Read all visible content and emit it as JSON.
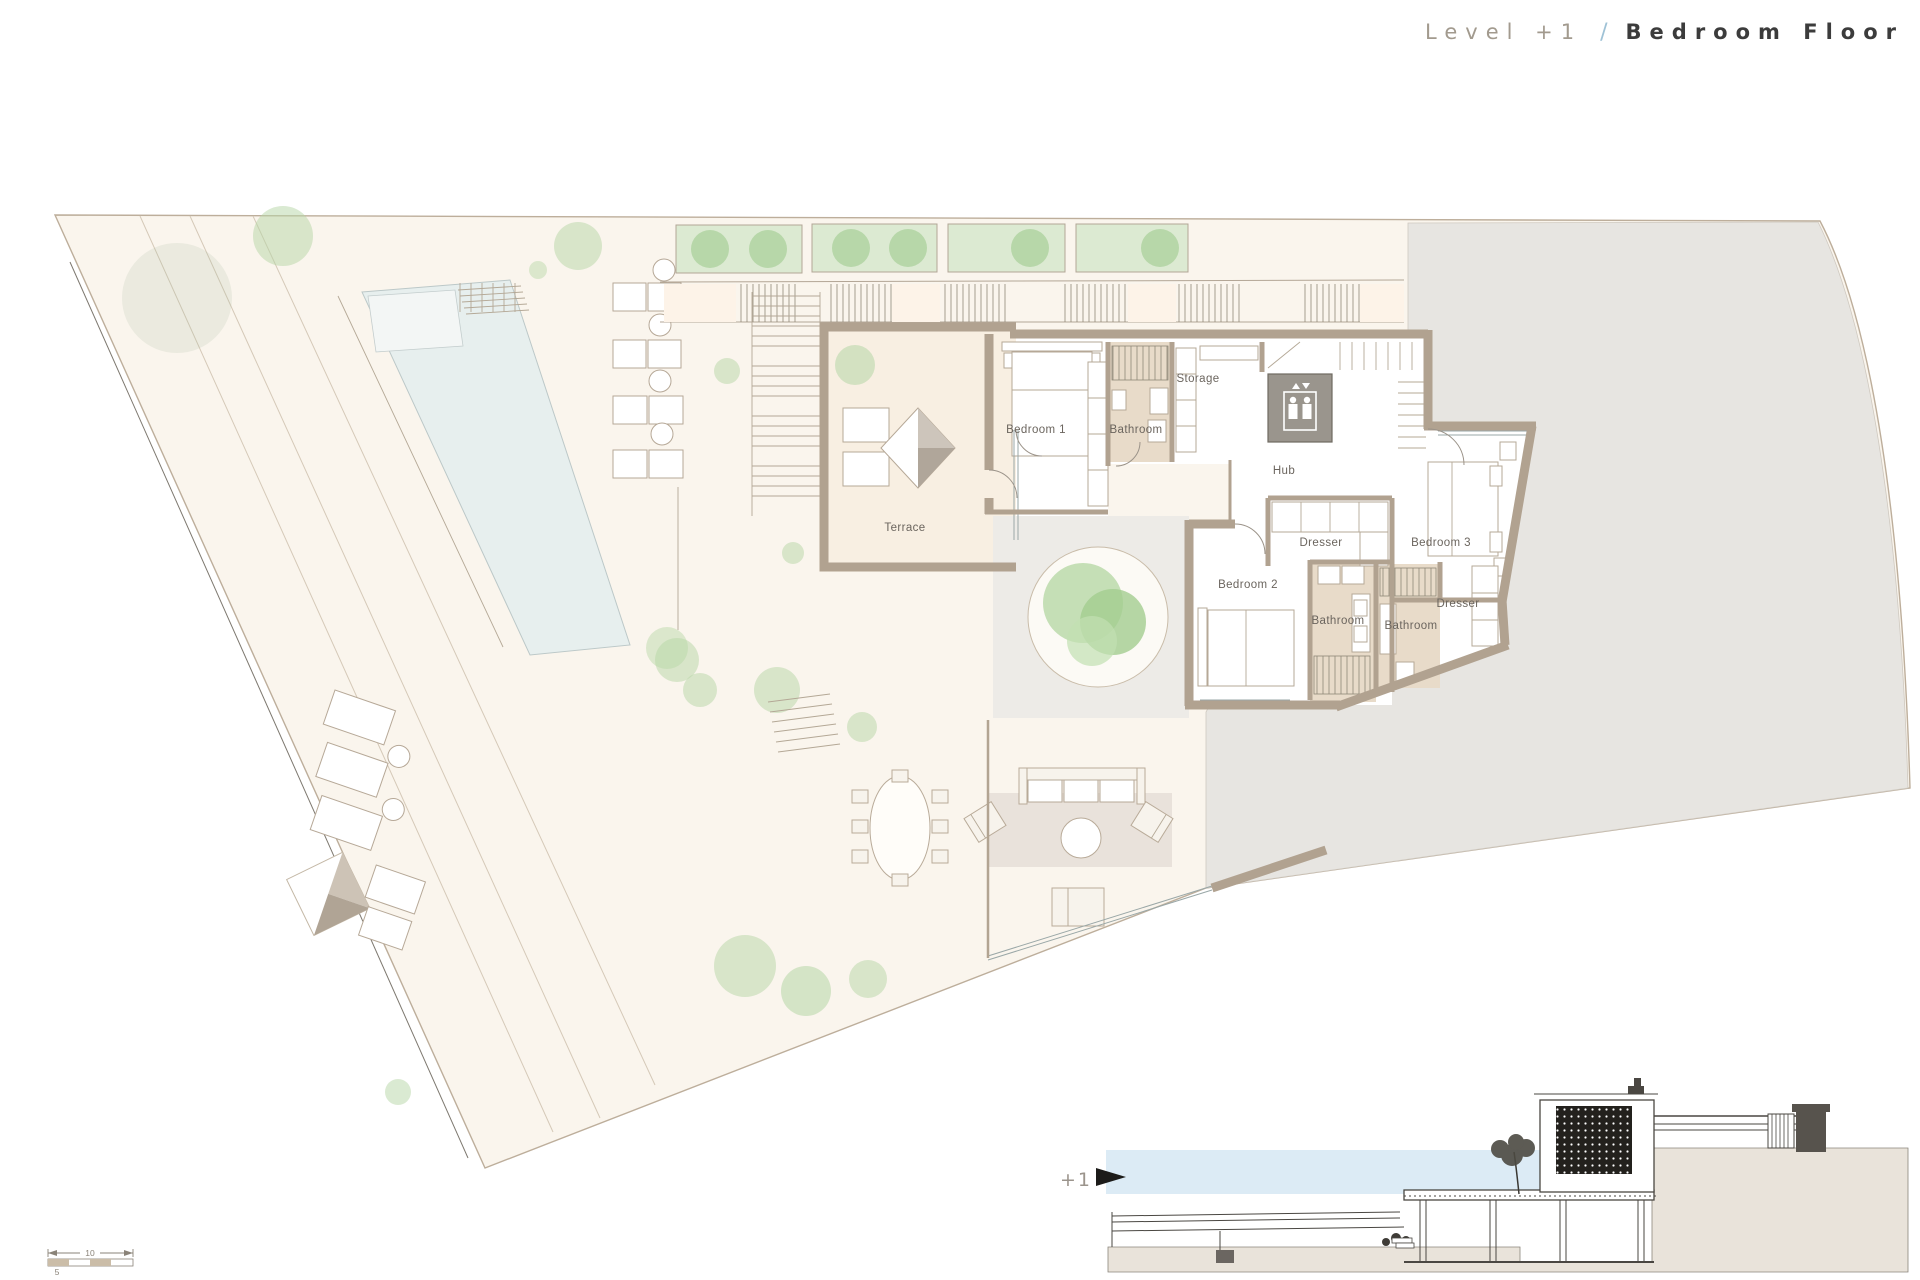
{
  "title": {
    "level": "Level +1",
    "separator": "/",
    "floor_name": "Bedroom Floor"
  },
  "plan": {
    "rooms": {
      "terrace": "Terrace",
      "bedroom1": "Bedroom 1",
      "bathroom1": "Bathroom",
      "storage": "Storage",
      "hub": "Hub",
      "dresser_upper": "Dresser",
      "bedroom3": "Bedroom 3",
      "bedroom2": "Bedroom 2",
      "bathroom2": "Bathroom",
      "bathroom3": "Bathroom",
      "dresser_lower": "Dresser"
    },
    "icons": {
      "elevator": "elevator-icon",
      "parasol": "parasol-icon",
      "tree": "tree-icon"
    }
  },
  "section": {
    "level_marker": "+1"
  },
  "scale_bar": {
    "major_label": "10",
    "minor_label": "5"
  },
  "colors": {
    "site_fill": "#faf5ed",
    "panel_peach": "#fdf3e8",
    "wall": "#b1a290",
    "bathroom_floor": "#e8dbc9",
    "terrace_floor": "#f8efe2",
    "neighbor_gray": "#e7e5e1",
    "courtyard_gray": "#edebe7",
    "pool_water": "#e7efee",
    "planter_green": "#dcead2",
    "planter_circle": "#b7d7a9",
    "tree_green": "#b5d6a5",
    "elevator_gray": "#9a958d",
    "section_sky": "#dcebf5",
    "section_ground": "#e9e3da",
    "title_level": "#a29a8e",
    "title_separator": "#9fc2d6",
    "title_name": "#3c3c3c"
  }
}
